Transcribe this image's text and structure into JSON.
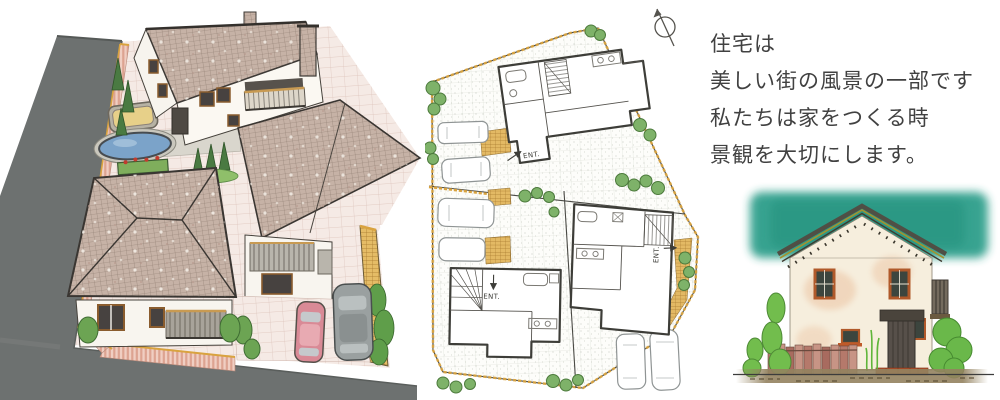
{
  "caption": {
    "lines": [
      "住宅は",
      "美しい街の風景の一部です",
      "私たちは家をつくる時",
      "景観を大切にします。"
    ]
  },
  "site_plan": {
    "entrance_label": "ENT.",
    "north_arrow": "north-arrow"
  },
  "palette": {
    "ink": "#414141",
    "road_gray": "#6d7170",
    "roof_tile": "#c6b2a6",
    "brick_fence_pink": "#eec6ba",
    "pond_blue": "#7ba3c9",
    "sandbox_tan": "#e7d089",
    "foliage_green": "#69a556",
    "plan_fence_orange": "#d9a33f",
    "sky_teal": "#2f9f8b",
    "bush_green": "#72bd4d",
    "wall_cream": "#f6eedd",
    "window_frame_orange": "#b0592a"
  }
}
